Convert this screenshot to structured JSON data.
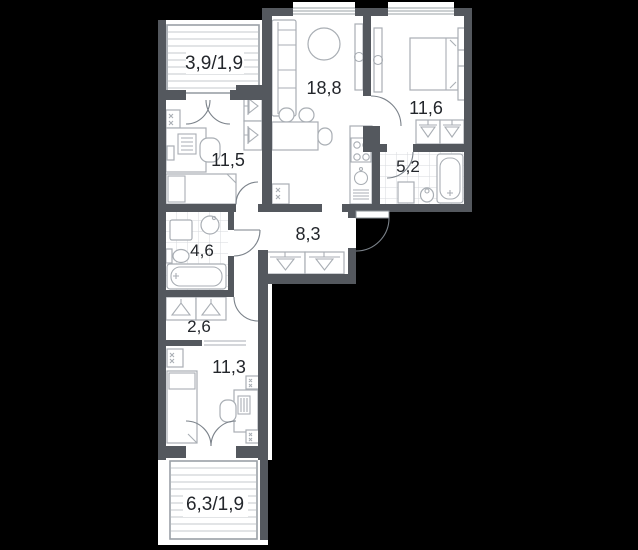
{
  "plan": {
    "type": "apartment-floor-plan",
    "background_color": "#000000",
    "wall_color": "#54585e",
    "floor_color": "#ffffff",
    "furniture_line_color": "#a9aeb4",
    "tile_line_color": "#d7dadd",
    "hatch_line_color": "#c6cacd",
    "door_arc_color": "#7b828a",
    "label_color": "#23262b",
    "rooms": [
      {
        "id": "balcony-top",
        "label": "3,9/1,9",
        "kind": "balcony"
      },
      {
        "id": "living-room",
        "label": "18,8",
        "kind": "living-room-kitchen"
      },
      {
        "id": "bedroom-right",
        "label": "11,6",
        "kind": "bedroom"
      },
      {
        "id": "bedroom-left",
        "label": "11,5",
        "kind": "bedroom"
      },
      {
        "id": "bathroom-small",
        "label": "5,2",
        "kind": "bathroom"
      },
      {
        "id": "bathroom-large",
        "label": "4,6",
        "kind": "bathroom"
      },
      {
        "id": "hallway",
        "label": "8,3",
        "kind": "hallway"
      },
      {
        "id": "corridor",
        "label": "2,6",
        "kind": "corridor"
      },
      {
        "id": "bedroom-bottom",
        "label": "11,3",
        "kind": "bedroom"
      },
      {
        "id": "balcony-bottom",
        "label": "6,3/1,9",
        "kind": "balcony"
      }
    ]
  }
}
